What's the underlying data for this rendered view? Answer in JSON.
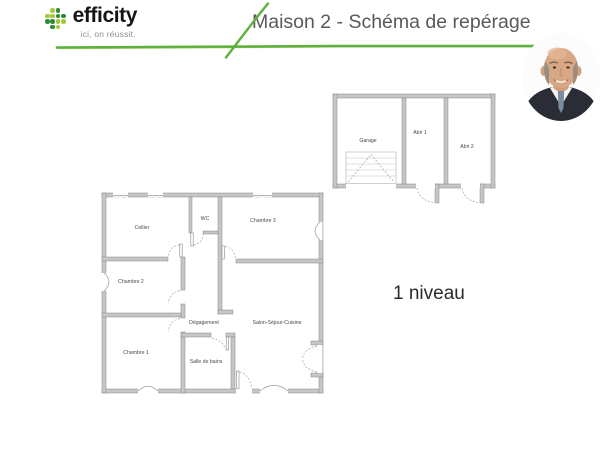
{
  "brand": {
    "name": "efficity",
    "tagline": "ici, on réussit.",
    "accent": "#5cb13b",
    "dots": {
      "dark": "#2e8b33",
      "light": "#a6c83b",
      "pattern": [
        "-LD-",
        "LLDD",
        "DDLL",
        "-DL-"
      ]
    }
  },
  "header": {
    "title": "Maison 2 - Schéma de repérage"
  },
  "caption": {
    "level": "1 niveau"
  },
  "floorplans": {
    "annex": {
      "garage": "Garage",
      "abri1": "Abri 1",
      "abri2": "Abri 2"
    },
    "house": {
      "cellier": "Cellier",
      "wc": "WC",
      "chambre3": "Chambre 3",
      "chambre2": "Chambre 2",
      "degagement": "Dégagement",
      "salon": "Salon-Séjour-Cuisine",
      "chambre1": "Chambre 1",
      "sdb": "Salle de bains"
    }
  }
}
